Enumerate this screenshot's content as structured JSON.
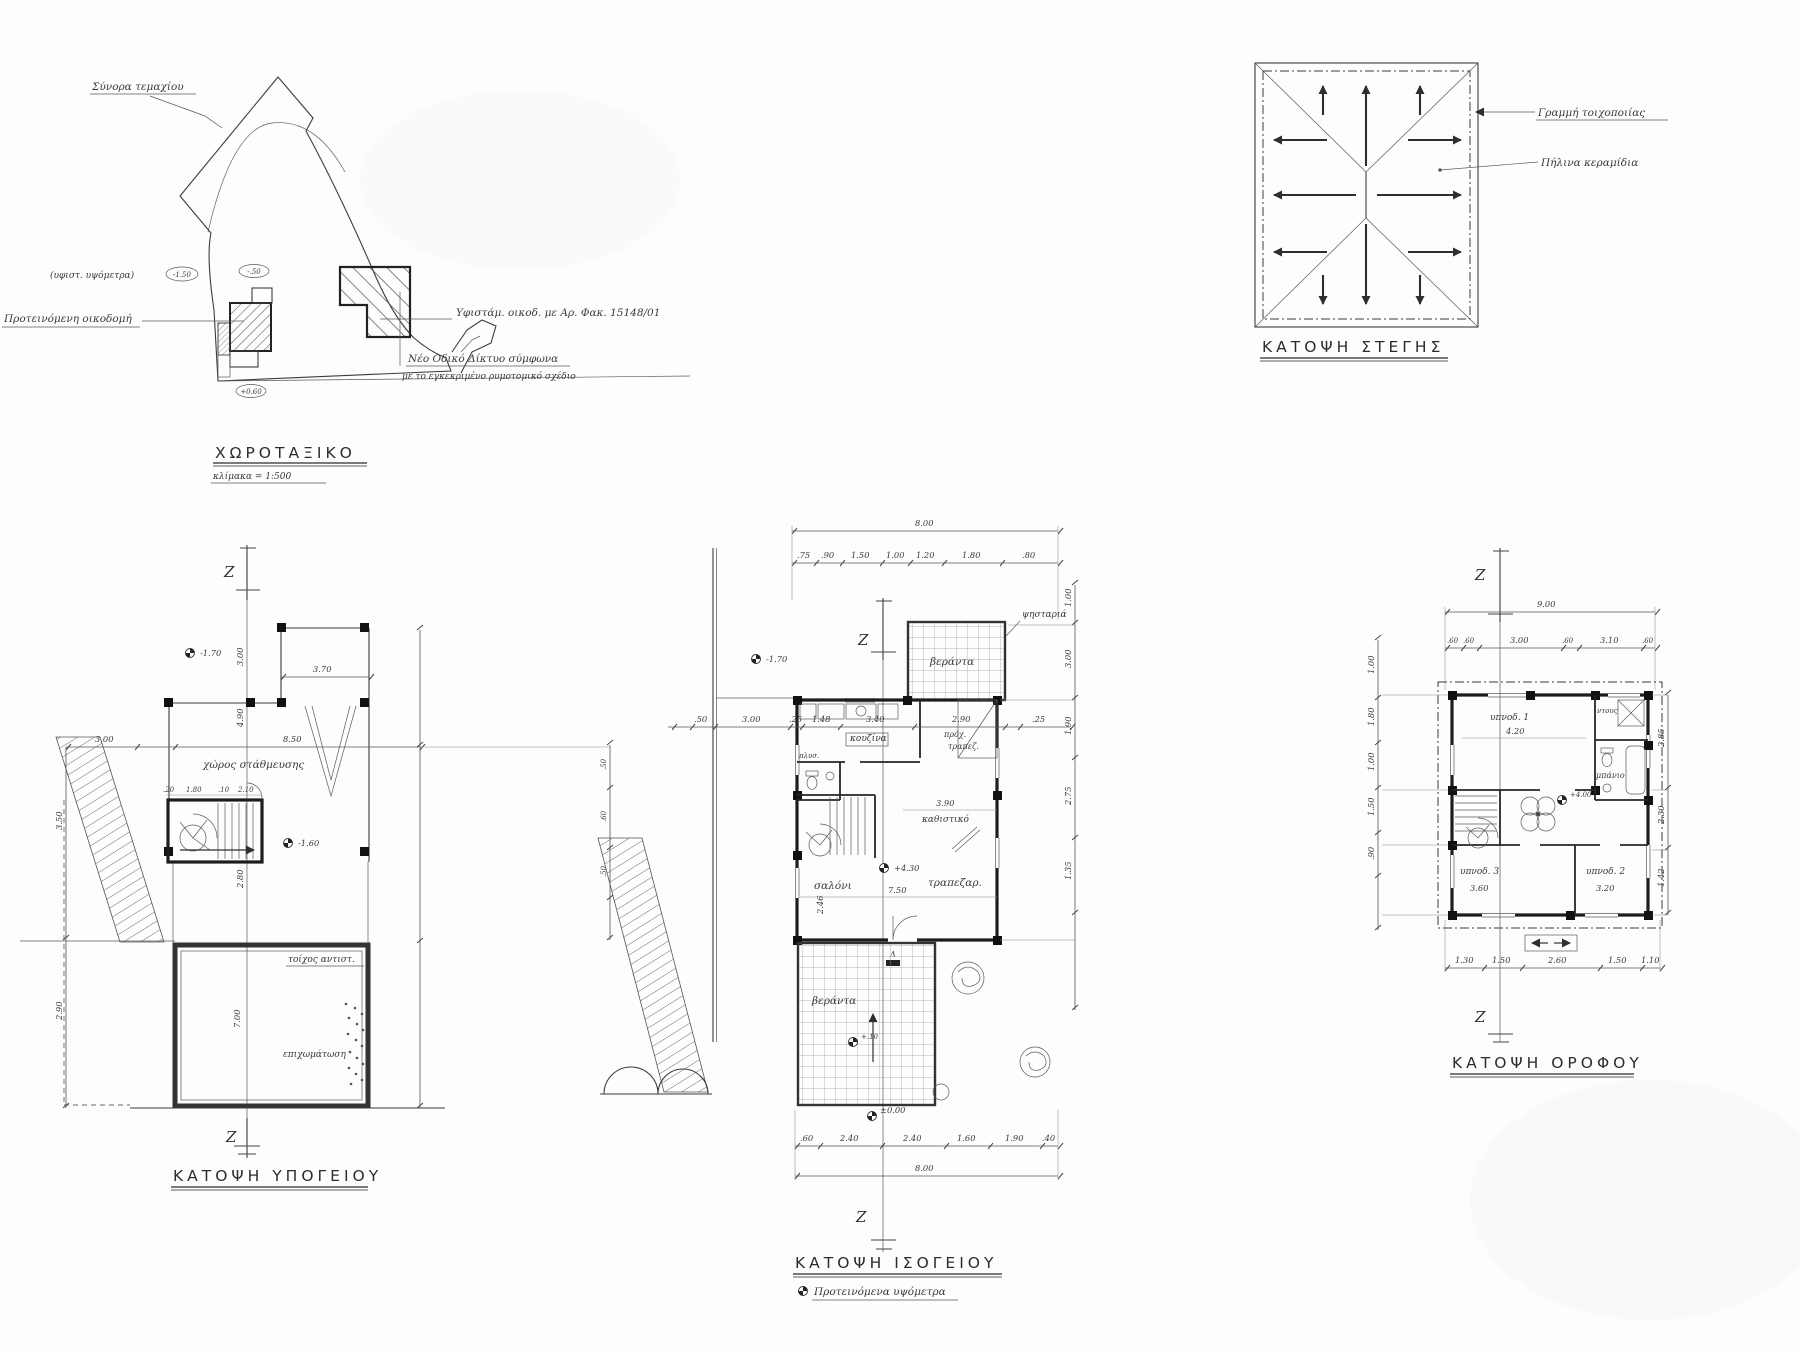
{
  "site": {
    "title": "ΧΩΡΟΤΑΞΙΚΟ",
    "scale": "κλίμακα = 1:500",
    "boundary_label": "Σύνορα τεμαχίου",
    "existing_elev_label": "(υφιστ. υψόμετρα)",
    "elev1": "-1.50",
    "elev2": "-.50",
    "elev3": "+0.60",
    "proposed_label": "Προτεινόμενη οικοδομή",
    "existing_label": "Υφιστάμ. οικοδ. με Αρ. Φακ. 15148/01",
    "road_line1": "Νέο Οδικό Δίκτυο σύμφωνα",
    "road_line2": "με το εγκεκριμένο ρυμοτομικό σχέδιο"
  },
  "roof": {
    "title": "ΚΑΤΟΨΗ ΣΤΕΓΗΣ",
    "masonry": "Γραμμή τοιχοποιίας",
    "tiles": "Πήλινα κεραμίδια"
  },
  "basement": {
    "title": "ΚΑΤΟΨΗ ΥΠΟΓΕΙΟΥ",
    "section": "Z",
    "parking": "χώρος στάθμευσης",
    "wall_label": "τοίχος αντιστ.",
    "fill_label": "επιχωμάτωση",
    "lvl_top": "-1.70",
    "lvl_stair": "-1.60",
    "dims": {
      "w1": "3.70",
      "w2": "3.00",
      "w3": "8.50",
      "v1": "3.00",
      "v2": "4.90",
      "v3": "2.80",
      "v4": "7.00",
      "l1": "3.50",
      "l2": "2.90",
      "s1": ".20",
      "s2": "1.80",
      "s3": ".10",
      "s4": "2.10"
    }
  },
  "ground": {
    "title": "ΚΑΤΟΨΗ ΙΣΟΓΕΙΟΥ",
    "legend": "Προτεινόμενα υψόμετρα",
    "legend_sym": "⊕",
    "section": "Z",
    "rooms": {
      "veranda_top": "βεράντα",
      "bbq": "ψησταριά",
      "kitchen": "κουζίνα",
      "laundry": "πλυσ.",
      "pantry1": "πρόχ.",
      "pantry2": "τραπεζ.",
      "sitting": "καθιστικό",
      "living": "σαλόνι",
      "dining": "τραπεζαρ.",
      "veranda_low": "βεράντα",
      "delta": "Δ"
    },
    "levels": {
      "yard": "-1.70",
      "main": "+4.30",
      "terrace": "+.10",
      "zero": "±0.00"
    },
    "dims_total_top": "8.00",
    "dims_total_bottom": "8.00",
    "dims_top": [
      ".75",
      ".90",
      "1.50",
      "1.00",
      "1.20",
      "1.80",
      ".80"
    ],
    "dims_mid": [
      ".50",
      "3.00",
      ".25",
      "1.48",
      "3.40",
      "2.90",
      ".25"
    ],
    "dims_bottom": [
      ".60",
      "2.40",
      "2.40",
      "1.60",
      "1.90",
      ".40"
    ],
    "dims_inner": {
      "sit": "3.90",
      "liv": "7.50",
      "d1": "2.46"
    },
    "dims_right": [
      "1.00",
      "3.00",
      "1.90",
      "2.75",
      "1.35"
    ],
    "dims_left": [
      ".50",
      ".60",
      ".50"
    ]
  },
  "floor": {
    "title": "ΚΑΤΟΨΗ ΟΡΟΦΟΥ",
    "section": "Z",
    "rooms": {
      "bed1": "υπνοδ. 1",
      "bed2": "υπνοδ. 2",
      "bed3": "υπνοδ. 3",
      "bath": "μπάνιο",
      "shower": "ντους"
    },
    "level": "+4.00",
    "dims_total_top": "9.00",
    "dims_top": [
      ".60",
      ".60",
      "3.00",
      ".60",
      "3.10",
      ".60"
    ],
    "dims_bottom": [
      "1.30",
      "1.50",
      "2.60",
      "1.50",
      "1.10"
    ],
    "dims_left": [
      "1.00",
      "1.80",
      "1.00",
      "1.50",
      ".90"
    ],
    "dims_right": [
      "2.85",
      "2.30",
      "1.42"
    ],
    "dims_inner": {
      "bed1": "4.20",
      "bed3": "3.60",
      "bed2": "3.20"
    }
  }
}
